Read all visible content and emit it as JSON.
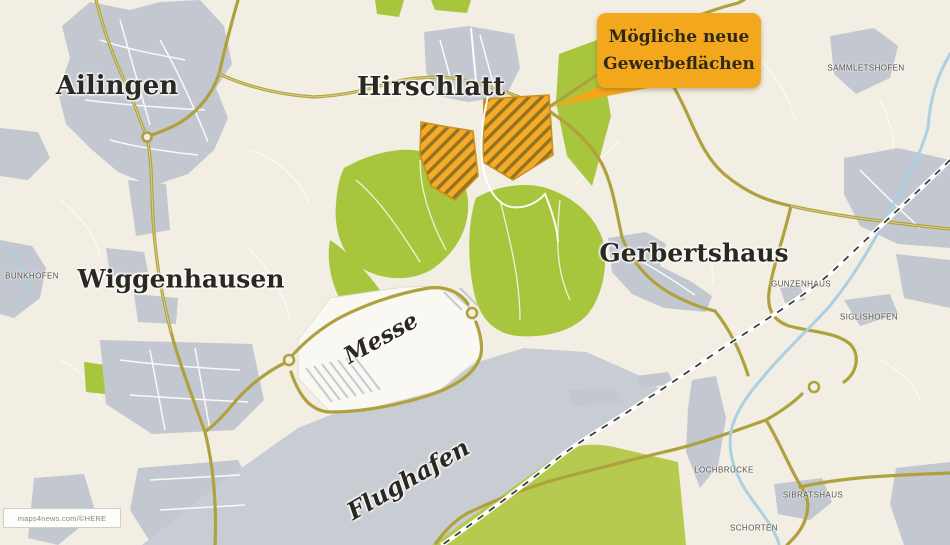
{
  "callout": {
    "line1": "Mögliche neue",
    "line2": "Gewerbeflächen",
    "bg": "#F3A71D",
    "text_color": "#2F2817"
  },
  "labels": {
    "ailingen": "Ailingen",
    "hirschlatt": "Hirschlatt",
    "wiggenhausen": "Wiggenhausen",
    "gerbertshaus": "Gerbertshaus",
    "messe": "Messe",
    "flughafen": "Flughafen"
  },
  "small_labels": {
    "sammletshofen": "SAMMLETSHOFEN",
    "bunkhofen": "BUNKHOFEN",
    "gunzenhaus": "GUNZENHAUS",
    "siglishofen": "SIGLISHOFEN",
    "lochbruecke": "LOCHBRÜCKE",
    "sibratshaus": "SIBRATSHAUS",
    "schorten": "SCHORTEN"
  },
  "proposed_sites": {
    "count": 2,
    "meaning": "Mögliche neue Gewerbeflächen"
  },
  "credit": "maps4news.com/©HERE",
  "colors": {
    "background": "#F2EEE3",
    "urban": "#C3C7CF",
    "airport": "#C8CCD3",
    "green": "#A7C63D",
    "green_south": "#B6CA4F",
    "road": "#AFA13E",
    "road_center": "#DCCF85",
    "white_road": "#FFFFFF",
    "river": "#ABD0E2",
    "railway": "#3F3F3F",
    "site_fill": "#F5AB28",
    "site_hatch": "#7C6420",
    "site_outline": "#C8901C",
    "label_color": "#2B2721"
  }
}
